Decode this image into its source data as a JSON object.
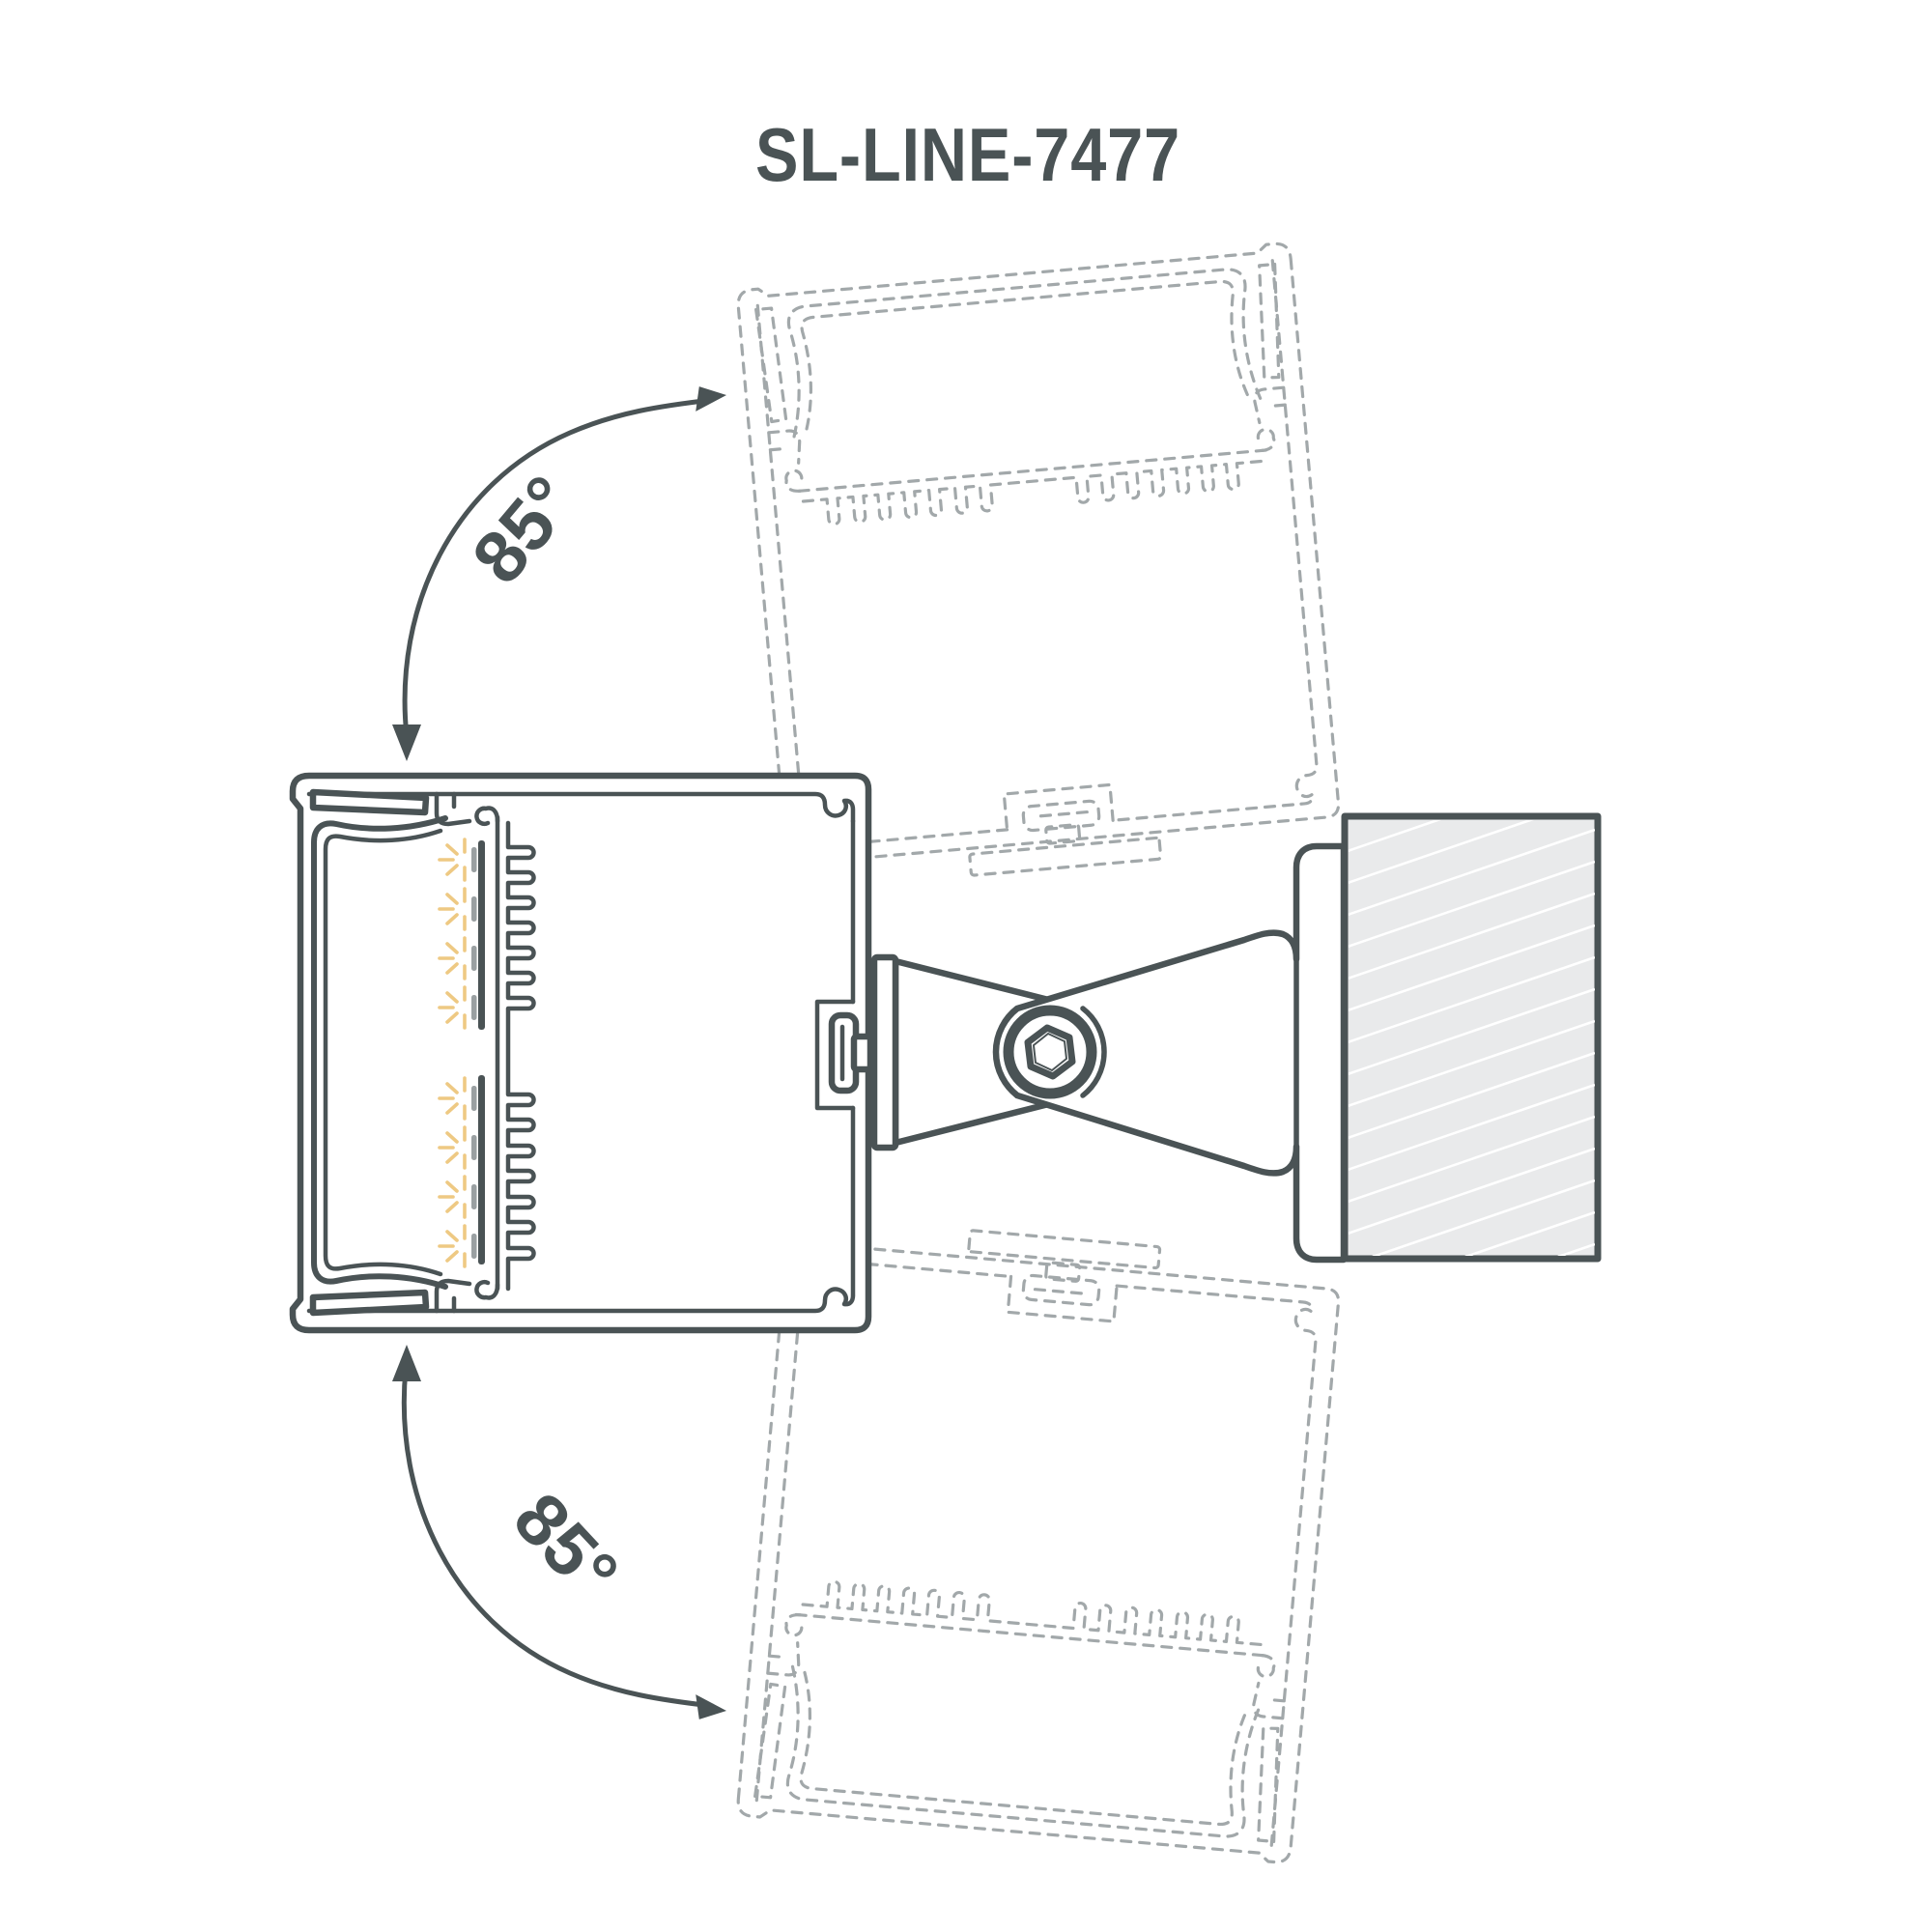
{
  "page": {
    "background_color": "#ffffff"
  },
  "title": {
    "text": "SL-LINE-7477",
    "color": "#4a5355"
  },
  "annotations": {
    "top_angle_label": "85°",
    "bottom_angle_label": "85°"
  },
  "diagram": {
    "rotation_range_degrees": 85,
    "pivot": {
      "type": "hex-socket-screw"
    },
    "colors": {
      "ink": "#4a5355",
      "ghost_dashed": "#a2a8aa",
      "wall_fill": "#e9eaeb",
      "wall_hatch": "#ffffff",
      "led_ray": "#eec983",
      "led_chip": "#9aa0a2"
    },
    "icons": {
      "hex_socket_screw_icon": "hexagon-in-ring",
      "rotation_arrow_icon": "curved-double-arrow",
      "led_rays_icon": "radiating-light-ticks"
    }
  }
}
